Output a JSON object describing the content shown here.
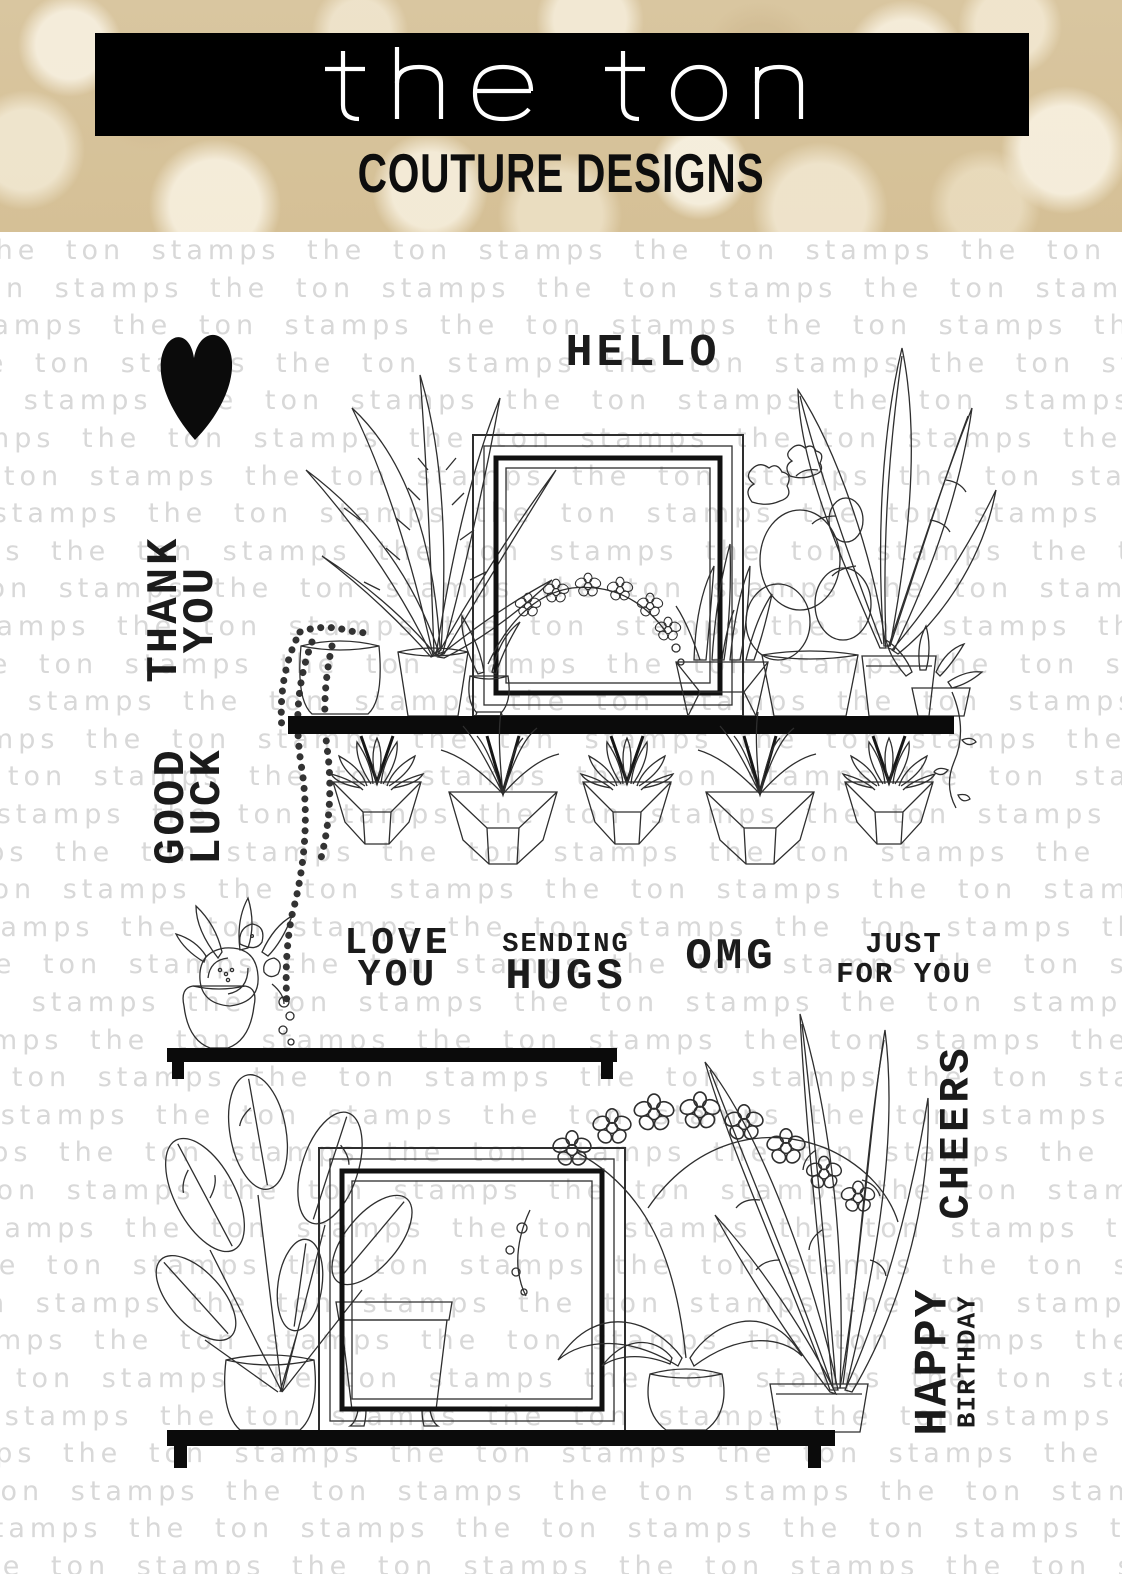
{
  "header": {
    "brand": "the ton",
    "subtitle": "COUTURE DESIGNS"
  },
  "watermark": {
    "text": "the ton stamps",
    "color": "#d8d8d8"
  },
  "sentiments": {
    "hello": "HELLO",
    "thank_you": {
      "line1": "THANK",
      "line2": "YOU"
    },
    "good_luck": {
      "line1": "GOOD",
      "line2": "LUCK"
    },
    "love_you": {
      "line1": "LOVE",
      "line2": "YOU"
    },
    "sending_hugs": {
      "line1": "SENDING",
      "line2": "HUGS"
    },
    "omg": "OMG",
    "just_for_you": {
      "line1": "JUST",
      "line2": "FOR YOU"
    },
    "cheers": "CHEERS",
    "happy_birthday": {
      "line1": "HAPPY",
      "line2": "BIRTHDAY"
    }
  },
  "illustrations": {
    "heart": "solid heart",
    "top_scene": "shelf with string-of-pearls pot, palm plant, square frame, orchid sprig, aloe, speckled cactus, leafy plants and trailing vine",
    "hanging_planters": "five geometric hanging planters with succulents and air plants",
    "flower_vase": "vase with rose bouquet on small shelf",
    "bottom_scene": "shelf with rubber plant in dotted pot, footed pot, square frame, orchid in urn and large leaf plant"
  },
  "colors": {
    "banner": "#000000",
    "logo_text": "#ffffff",
    "subtitle_text": "#0d0d0d",
    "ink": "#2e2e2e",
    "stamp_text": "#1b1b1b",
    "watermark": "#d8d8d8",
    "bokeh_base": "#d9c6a0"
  }
}
